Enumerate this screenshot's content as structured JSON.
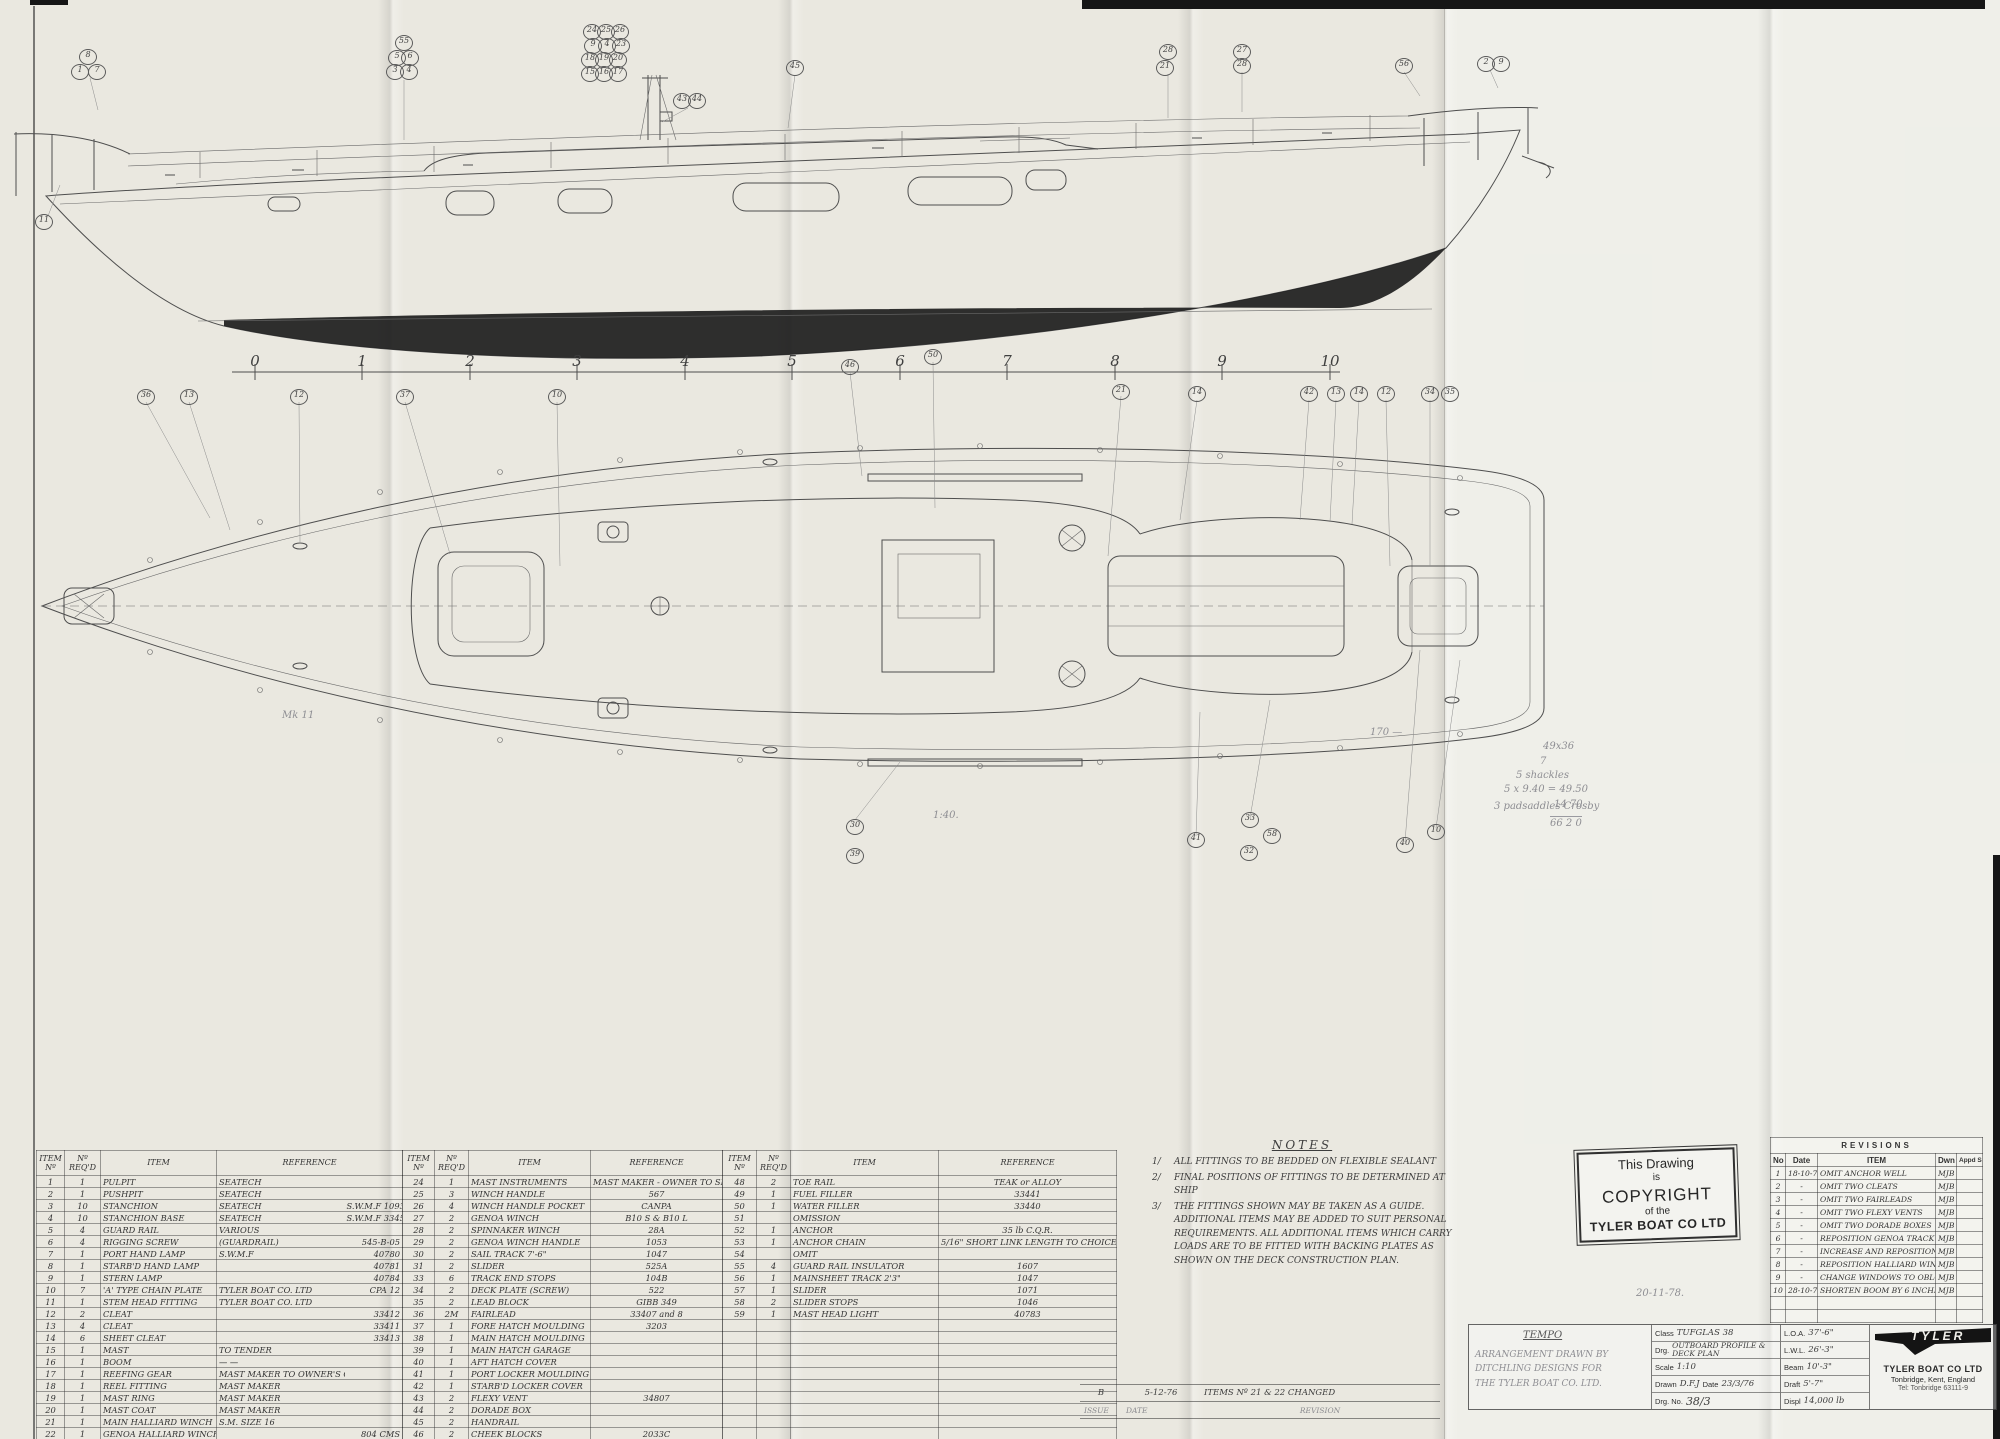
{
  "ruler": {
    "numbers": [
      {
        "t": "0",
        "x": 255
      },
      {
        "t": "1",
        "x": 362
      },
      {
        "t": "2",
        "x": 470
      },
      {
        "t": "3",
        "x": 577
      },
      {
        "t": "4",
        "x": 685
      },
      {
        "t": "5",
        "x": 792
      },
      {
        "t": "6",
        "x": 900
      },
      {
        "t": "7",
        "x": 1007
      },
      {
        "t": "8",
        "x": 1115
      },
      {
        "t": "9",
        "x": 1222
      },
      {
        "t": "10",
        "x": 1330
      }
    ]
  },
  "profile_balloons": [
    {
      "t": "8",
      "x": 88,
      "y": 57
    },
    {
      "t": "1",
      "x": 80,
      "y": 72
    },
    {
      "t": "7",
      "x": 97,
      "y": 72
    },
    {
      "t": "11",
      "x": 44,
      "y": 222
    },
    {
      "t": "55",
      "x": 404,
      "y": 43
    },
    {
      "t": "5",
      "x": 397,
      "y": 58
    },
    {
      "t": "6",
      "x": 410,
      "y": 58
    },
    {
      "t": "3",
      "x": 395,
      "y": 72
    },
    {
      "t": "4",
      "x": 409,
      "y": 72
    },
    {
      "t": "24",
      "x": 592,
      "y": 32
    },
    {
      "t": "25",
      "x": 606,
      "y": 32
    },
    {
      "t": "26",
      "x": 620,
      "y": 32
    },
    {
      "t": "9",
      "x": 593,
      "y": 46
    },
    {
      "t": "4",
      "x": 607,
      "y": 46
    },
    {
      "t": "23",
      "x": 621,
      "y": 46
    },
    {
      "t": "18",
      "x": 590,
      "y": 60
    },
    {
      "t": "19",
      "x": 604,
      "y": 60
    },
    {
      "t": "20",
      "x": 618,
      "y": 60
    },
    {
      "t": "15",
      "x": 590,
      "y": 74
    },
    {
      "t": "16",
      "x": 604,
      "y": 74
    },
    {
      "t": "17",
      "x": 618,
      "y": 74
    },
    {
      "t": "43",
      "x": 682,
      "y": 101
    },
    {
      "t": "44",
      "x": 697,
      "y": 101
    },
    {
      "t": "45",
      "x": 795,
      "y": 68
    },
    {
      "t": "28",
      "x": 1168,
      "y": 52
    },
    {
      "t": "21",
      "x": 1165,
      "y": 68
    },
    {
      "t": "27",
      "x": 1242,
      "y": 52
    },
    {
      "t": "28",
      "x": 1242,
      "y": 66
    },
    {
      "t": "56",
      "x": 1404,
      "y": 66
    },
    {
      "t": "2",
      "x": 1486,
      "y": 64
    },
    {
      "t": "9",
      "x": 1501,
      "y": 64
    }
  ],
  "plan_balloons": [
    {
      "t": "36",
      "x": 146,
      "y": 397
    },
    {
      "t": "13",
      "x": 189,
      "y": 397
    },
    {
      "t": "12",
      "x": 299,
      "y": 397
    },
    {
      "t": "37",
      "x": 405,
      "y": 397
    },
    {
      "t": "10",
      "x": 557,
      "y": 397
    },
    {
      "t": "46",
      "x": 850,
      "y": 367
    },
    {
      "t": "50",
      "x": 933,
      "y": 357
    },
    {
      "t": "21",
      "x": 1121,
      "y": 392
    },
    {
      "t": "14",
      "x": 1197,
      "y": 394
    },
    {
      "t": "42",
      "x": 1309,
      "y": 394
    },
    {
      "t": "13",
      "x": 1336,
      "y": 394
    },
    {
      "t": "14",
      "x": 1359,
      "y": 394
    },
    {
      "t": "12",
      "x": 1386,
      "y": 394
    },
    {
      "t": "34",
      "x": 1430,
      "y": 394
    },
    {
      "t": "35",
      "x": 1450,
      "y": 394
    },
    {
      "t": "30",
      "x": 855,
      "y": 827
    },
    {
      "t": "39",
      "x": 855,
      "y": 856
    },
    {
      "t": "41",
      "x": 1196,
      "y": 840
    },
    {
      "t": "33",
      "x": 1250,
      "y": 820
    },
    {
      "t": "32",
      "x": 1249,
      "y": 853
    },
    {
      "t": "58",
      "x": 1272,
      "y": 836
    },
    {
      "t": "40",
      "x": 1405,
      "y": 845
    },
    {
      "t": "10",
      "x": 1436,
      "y": 832
    }
  ],
  "pencil_notes": [
    {
      "t": "Mk 11",
      "x": 282,
      "y": 710
    },
    {
      "t": "1:40.",
      "x": 933,
      "y": 810
    },
    {
      "t": "170 —",
      "x": 1370,
      "y": 727
    },
    {
      "t": "49x36",
      "x": 1543,
      "y": 741
    },
    {
      "t": "7",
      "x": 1540,
      "y": 756
    },
    {
      "t": "5 shackles",
      "x": 1516,
      "y": 770
    },
    {
      "t": "5 x 9.40 = 49.50",
      "x": 1504,
      "y": 784
    },
    {
      "t": "3 padsaddles  Crosby",
      "x": 1494,
      "y": 801
    },
    {
      "t": "14 70",
      "x": 1554,
      "y": 799
    },
    {
      "t": "66 2 0",
      "x": 1550,
      "y": 816,
      "cls": "sum"
    },
    {
      "t": "20-11-78.",
      "x": 1636,
      "y": 1288
    }
  ],
  "tables": {
    "col_headers": {
      "item_no": "ITEM Nº",
      "req": "Nº REQ'D",
      "item": "ITEM",
      "ref": "REFERENCE"
    },
    "t1": [
      {
        "no": "1",
        "qty": "1",
        "item": "PULPIT",
        "ref": "SEATECH",
        "ref2": ""
      },
      {
        "no": "2",
        "qty": "1",
        "item": "PUSHPIT",
        "ref": "SEATECH",
        "ref2": ""
      },
      {
        "no": "3",
        "qty": "10",
        "item": "STANCHION",
        "ref": "SEATECH",
        "ref2": "S.W.M.F  1093"
      },
      {
        "no": "4",
        "qty": "10",
        "item": "STANCHION BASE",
        "ref": "SEATECH",
        "ref2": "S.W.M.F  33453"
      },
      {
        "no": "5",
        "qty": "4",
        "item": "GUARD RAIL",
        "ref": "VARIOUS",
        "ref2": ""
      },
      {
        "no": "6",
        "qty": "4",
        "item": "RIGGING SCREW",
        "ref": "(GUARDRAIL)",
        "ref2": "545-B-05"
      },
      {
        "no": "7",
        "qty": "1",
        "item": "PORT HAND LAMP",
        "ref": "S.W.M.F",
        "ref2": "40780"
      },
      {
        "no": "8",
        "qty": "1",
        "item": "STARB'D HAND LAMP",
        "ref": "",
        "ref2": "40781"
      },
      {
        "no": "9",
        "qty": "1",
        "item": "STERN LAMP",
        "ref": "",
        "ref2": "40784"
      },
      {
        "no": "10",
        "qty": "7",
        "item": "'A' TYPE CHAIN PLATE",
        "ref": "TYLER BOAT CO. LTD",
        "ref2": "CPA 12"
      },
      {
        "no": "11",
        "qty": "1",
        "item": "STEM HEAD FITTING",
        "ref": "TYLER BOAT CO. LTD",
        "ref2": ""
      },
      {
        "no": "12",
        "qty": "2",
        "item": "CLEAT",
        "ref": "",
        "ref2": "33412"
      },
      {
        "no": "13",
        "qty": "4",
        "item": "CLEAT",
        "ref": "",
        "ref2": "33411"
      },
      {
        "no": "14",
        "qty": "6",
        "item": "SHEET CLEAT",
        "ref": "",
        "ref2": "33413"
      },
      {
        "no": "15",
        "qty": "1",
        "item": "MAST",
        "ref": "TO TENDER",
        "ref2": ""
      },
      {
        "no": "16",
        "qty": "1",
        "item": "BOOM",
        "ref": "— —",
        "ref2": ""
      },
      {
        "no": "17",
        "qty": "1",
        "item": "REEFING GEAR",
        "ref": "MAST MAKER TO OWNER'S CHOICE",
        "ref2": ""
      },
      {
        "no": "18",
        "qty": "1",
        "item": "REEL FITTING",
        "ref": "MAST MAKER",
        "ref2": ""
      },
      {
        "no": "19",
        "qty": "1",
        "item": "MAST RING",
        "ref": "MAST MAKER",
        "ref2": ""
      },
      {
        "no": "20",
        "qty": "1",
        "item": "MAST COAT",
        "ref": "MAST MAKER",
        "ref2": ""
      },
      {
        "no": "21",
        "qty": "1",
        "item": "MAIN HALLIARD WINCH",
        "ref": "S.M.  SIZE 16",
        "ref2": ""
      },
      {
        "no": "22",
        "qty": "1",
        "item": "GENOA HALLIARD WINCH",
        "ref": "",
        "ref2": "804 CMS"
      },
      {
        "no": "23",
        "qty": "1",
        "item": "MAST LIGHTS",
        "ref": "MASTMAKER - OWNER TO SPECIFY",
        "ref2": ""
      }
    ],
    "t2": [
      {
        "no": "24",
        "qty": "1",
        "item": "MAST INSTRUMENTS",
        "ref": "MAST MAKER - OWNER TO SPECIFY"
      },
      {
        "no": "25",
        "qty": "3",
        "item": "WINCH HANDLE",
        "ref": "567"
      },
      {
        "no": "26",
        "qty": "4",
        "item": "WINCH HANDLE POCKET",
        "ref": "CANPA"
      },
      {
        "no": "27",
        "qty": "2",
        "item": "GENOA WINCH",
        "ref": "B10 S & B10 L"
      },
      {
        "no": "28",
        "qty": "2",
        "item": "SPINNAKER WINCH",
        "ref": "28A"
      },
      {
        "no": "29",
        "qty": "2",
        "item": "GENOA WINCH HANDLE",
        "ref": "1053"
      },
      {
        "no": "30",
        "qty": "2",
        "item": "SAIL TRACK  7'-6\"",
        "ref": "1047"
      },
      {
        "no": "31",
        "qty": "2",
        "item": "SLIDER",
        "ref": "525A"
      },
      {
        "no": "33",
        "qty": "6",
        "item": "TRACK END STOPS",
        "ref": "104B"
      },
      {
        "no": "34",
        "qty": "2",
        "item": "DECK PLATE (SCREW)",
        "ref": "522"
      },
      {
        "no": "35",
        "qty": "2",
        "item": "LEAD BLOCK",
        "ref": "GIBB  349"
      },
      {
        "no": "36",
        "qty": "2M",
        "item": "FAIRLEAD",
        "ref": "33407 and 8"
      },
      {
        "no": "37",
        "qty": "1",
        "item": "FORE HATCH MOULDING",
        "ref": "3203"
      },
      {
        "no": "38",
        "qty": "1",
        "item": "MAIN HATCH MOULDING",
        "ref": ""
      },
      {
        "no": "39",
        "qty": "1",
        "item": "MAIN HATCH GARAGE",
        "ref": ""
      },
      {
        "no": "40",
        "qty": "1",
        "item": "AFT HATCH COVER",
        "ref": ""
      },
      {
        "no": "41",
        "qty": "1",
        "item": "PORT LOCKER MOULDING",
        "ref": ""
      },
      {
        "no": "42",
        "qty": "1",
        "item": "STARB'D LOCKER COVER",
        "ref": ""
      },
      {
        "no": "43",
        "qty": "2",
        "item": "FLEXY VENT",
        "ref": "34807"
      },
      {
        "no": "44",
        "qty": "2",
        "item": "DORADE BOX",
        "ref": ""
      },
      {
        "no": "45",
        "qty": "2",
        "item": "HANDRAIL",
        "ref": ""
      },
      {
        "no": "46",
        "qty": "2",
        "item": "CHEEK BLOCKS",
        "ref": "2033C"
      },
      {
        "no": "47",
        "qty": "2",
        "item": "HALYARD CLEATS",
        "ref": "33410"
      },
      {
        "no": "",
        "qty": "",
        "item": "",
        "ref": ""
      }
    ],
    "t3": [
      {
        "no": "48",
        "qty": "2",
        "item": "TOE RAIL",
        "ref": "TEAK or ALLOY"
      },
      {
        "no": "49",
        "qty": "1",
        "item": "FUEL FILLER",
        "ref": "33441"
      },
      {
        "no": "50",
        "qty": "1",
        "item": "WATER FILLER",
        "ref": "33440"
      },
      {
        "no": "51",
        "qty": "",
        "item": "OMISSION",
        "ref": ""
      },
      {
        "no": "52",
        "qty": "1",
        "item": "ANCHOR",
        "ref": "35 lb  C.Q.R."
      },
      {
        "no": "53",
        "qty": "1",
        "item": "ANCHOR CHAIN",
        "ref": "5/16\" SHORT LINK  LENGTH TO CHOICE"
      },
      {
        "no": "54",
        "qty": "",
        "item": "OMIT",
        "ref": ""
      },
      {
        "no": "55",
        "qty": "4",
        "item": "GUARD RAIL INSULATOR",
        "ref": "1607"
      },
      {
        "no": "56",
        "qty": "1",
        "item": "MAINSHEET TRACK 2'3\"",
        "ref": "1047"
      },
      {
        "no": "57",
        "qty": "1",
        "item": "SLIDER",
        "ref": "1071"
      },
      {
        "no": "58",
        "qty": "2",
        "item": "SLIDER STOPS",
        "ref": "1046"
      },
      {
        "no": "59",
        "qty": "1",
        "item": "MAST HEAD LIGHT",
        "ref": "40783"
      },
      {
        "no": "",
        "qty": "",
        "item": "",
        "ref": ""
      },
      {
        "no": "",
        "qty": "",
        "item": "",
        "ref": ""
      },
      {
        "no": "",
        "qty": "",
        "item": "",
        "ref": ""
      },
      {
        "no": "",
        "qty": "",
        "item": "",
        "ref": ""
      },
      {
        "no": "",
        "qty": "",
        "item": "",
        "ref": ""
      },
      {
        "no": "",
        "qty": "",
        "item": "",
        "ref": ""
      },
      {
        "no": "",
        "qty": "",
        "item": "",
        "ref": ""
      },
      {
        "no": "",
        "qty": "",
        "item": "",
        "ref": ""
      },
      {
        "no": "",
        "qty": "",
        "item": "",
        "ref": ""
      },
      {
        "no": "",
        "qty": "",
        "item": "",
        "ref": ""
      },
      {
        "no": "12",
        "qty": "1",
        "item": "OPTION 2 KEYED Nº BOLLARD",
        "ref": ""
      },
      {
        "no": "32",
        "qty": "",
        "item": "OMISSION",
        "ref": ""
      }
    ]
  },
  "notes": {
    "title": "NOTES",
    "items": [
      {
        "no": "1/",
        "text": "ALL FITTINGS TO BE BEDDED ON FLEXIBLE SEALANT"
      },
      {
        "no": "2/",
        "text": "FINAL POSITIONS OF FITTINGS TO BE DETERMINED AT SHIP"
      },
      {
        "no": "3/",
        "text": "THE FITTINGS SHOWN MAY BE TAKEN AS A GUIDE. ADDITIONAL ITEMS MAY BE ADDED TO SUIT PERSONAL REQUIREMENTS. ALL ADDITIONAL ITEMS WHICH CARRY LOADS ARE TO BE FITTED WITH BACKING PLATES AS SHOWN ON THE DECK CONSTRUCTION PLAN."
      }
    ]
  },
  "stamp": {
    "l1": "This Drawing",
    "l2": "is",
    "l3": "COPYRIGHT",
    "l4": "of the",
    "l5": "TYLER BOAT CO LTD"
  },
  "revisions": {
    "title": "REVISIONS",
    "h": {
      "no": "No",
      "date": "Date",
      "item": "ITEM",
      "dwn": "Dwn",
      "appd": "Appd S A"
    },
    "rows": [
      {
        "no": "1",
        "date": "18-10-71",
        "item": "OMIT ANCHOR WELL",
        "dwn": "MJB"
      },
      {
        "no": "2",
        "date": "-",
        "item": "OMIT TWO CLEATS",
        "dwn": "MJB"
      },
      {
        "no": "3",
        "date": "-",
        "item": "OMIT TWO FAIRLEADS",
        "dwn": "MJB"
      },
      {
        "no": "4",
        "date": "-",
        "item": "OMIT TWO FLEXY VENTS",
        "dwn": "MJB"
      },
      {
        "no": "5",
        "date": "-",
        "item": "OMIT TWO DORADE BOXES",
        "dwn": "MJB"
      },
      {
        "no": "6",
        "date": "-",
        "item": "REPOSITION GENOA TRACK",
        "dwn": "MJB"
      },
      {
        "no": "7",
        "date": "-",
        "item": "INCREASE AND REPOSITION STANCH'NS",
        "dwn": "MJB"
      },
      {
        "no": "8",
        "date": "-",
        "item": "REPOSITION HALLIARD WINCHES",
        "dwn": "MJB"
      },
      {
        "no": "9",
        "date": "-",
        "item": "CHANGE WINDOWS TO OBLONG TYPE",
        "dwn": "MJB"
      },
      {
        "no": "10",
        "date": "28-10-71",
        "item": "SHORTEN BOOM BY 6 INCHES",
        "dwn": "MJB"
      },
      {
        "no": "",
        "date": "",
        "item": "",
        "dwn": ""
      },
      {
        "no": "",
        "date": "",
        "item": "",
        "dwn": ""
      }
    ]
  },
  "issue_strip": {
    "issue": "B",
    "date": "5-12-76",
    "revision": "ITEMS Nº 21 & 22 CHANGED",
    "l_issue": "ISSUE",
    "l_date": "DATE",
    "l_rev": "REVISION"
  },
  "title_block": {
    "project": "TEMPO",
    "pencil_lines": [
      "ARRANGEMENT DRAWN BY",
      "DITCHLING DESIGNS FOR",
      "THE TYLER BOAT CO. LTD."
    ],
    "labels": {
      "cls": "Class",
      "drg": "Drg.",
      "scale": "Scale",
      "drawn": "Drawn",
      "date": "Date",
      "drg_no": "Drg. No.",
      "loa": "L.O.A.",
      "lwl": "L.W.L.",
      "beam": "Beam",
      "draft": "Draft",
      "displ": "Displ"
    },
    "values": {
      "cls": "TUFGLAS 38",
      "drg1": "OUTBOARD PROFILE &",
      "drg2": "DECK PLAN",
      "scale": "1:10",
      "drawn": "D.F.J",
      "date": "23/3/76",
      "drg_no": "38/3",
      "loa": "37'-6\"",
      "lwl": "26'-3\"",
      "beam": "10'-3\"",
      "draft": "5'-7\"",
      "displ": "14,000 lb"
    },
    "company": {
      "logo_text": "TYLER",
      "name": "TYLER BOAT CO LTD",
      "address": "Tonbridge, Kent, England",
      "tel": "Tel: Tonbridge 63111-9"
    }
  }
}
